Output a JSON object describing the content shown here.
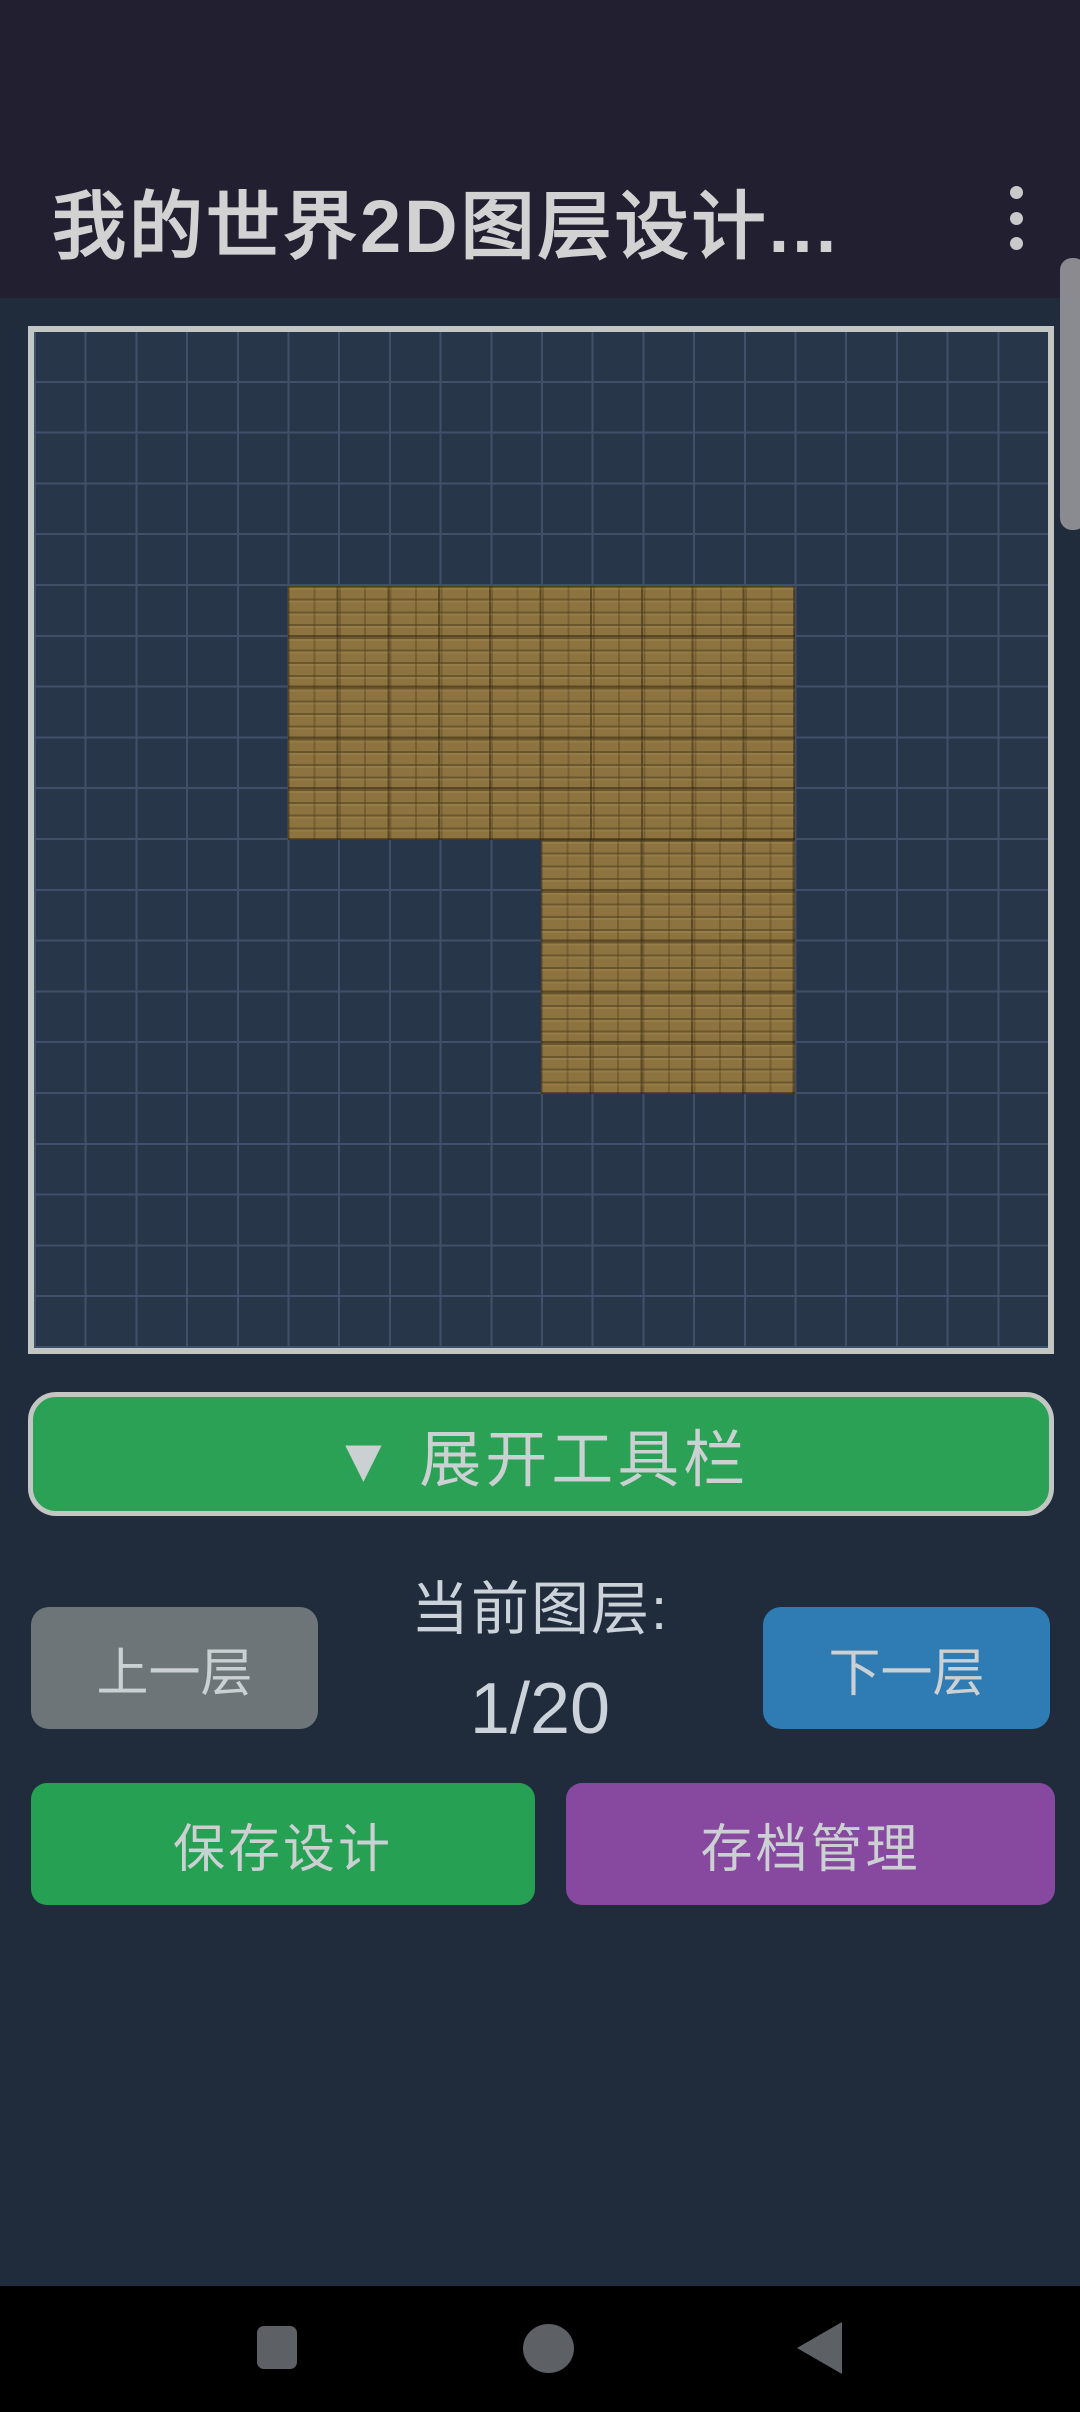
{
  "app": {
    "title": "我的世界2D图层设计...",
    "menu_icon": "kebab-menu-icon"
  },
  "canvas": {
    "grid_cols": 20,
    "grid_rows": 20,
    "block_type": "oak-planks",
    "filled_regions": [
      {
        "col": 5,
        "row": 5,
        "w": 10,
        "h": 5
      },
      {
        "col": 10,
        "row": 10,
        "w": 5,
        "h": 5
      }
    ]
  },
  "toolbar": {
    "expand_label": "▼ 展开工具栏"
  },
  "layer_controls": {
    "prev_label": "上一层",
    "current_label": "当前图层:",
    "current_value": "1/20",
    "next_label": "下一层"
  },
  "actions": {
    "save_label": "保存设计",
    "archive_label": "存档管理"
  },
  "nav_bar": {
    "icons": [
      "recents-square",
      "home-circle",
      "back-triangle"
    ]
  },
  "colors": {
    "header_bg": "#211f30",
    "content_bg": "#202c3b",
    "canvas_bg": "#283649",
    "grid_line": "#41506a",
    "canvas_border": "#c3c7c3",
    "wood_base": "#8d7340",
    "expand_green": "#2aa155",
    "save_green": "#26a052",
    "next_blue": "#2e7cb3",
    "prev_gray": "#6e7578",
    "archive_purple": "#87489f",
    "nav_icon_gray": "#5d6166"
  }
}
